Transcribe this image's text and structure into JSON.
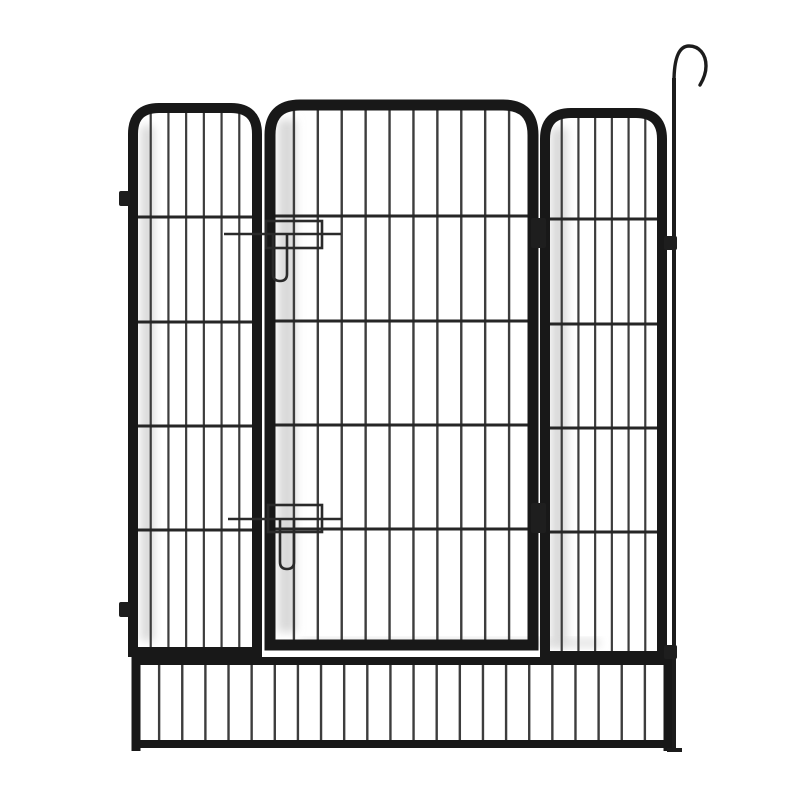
{
  "canvas": {
    "width": 800,
    "height": 800,
    "background": "#ffffff"
  },
  "colors": {
    "tube": "#181818",
    "wire": "#3d3d3d",
    "crossbar": "#262626",
    "hardware": "#1e1e1e",
    "latch_wire": "#2a2a2a",
    "shadow": "#d9d9d9",
    "stake": "#1c1c1c"
  },
  "panels": [
    {
      "id": "left-panel",
      "x1": 133,
      "x2": 257,
      "top": 108,
      "bottom": 652,
      "radius": 26,
      "tube_w": 10,
      "wires": 6,
      "wire_w": 2.2,
      "crossbars": [
        217,
        322,
        426,
        530
      ]
    },
    {
      "id": "gate-panel",
      "x1": 270,
      "x2": 533,
      "top": 105,
      "bottom": 645,
      "radius": 30,
      "tube_w": 11,
      "wires": 10,
      "wire_w": 2.4,
      "crossbars": [
        216,
        321,
        425,
        529
      ]
    },
    {
      "id": "right-panel",
      "x1": 545,
      "x2": 662,
      "top": 113,
      "bottom": 656,
      "radius": 26,
      "tube_w": 10,
      "wires": 6,
      "wire_w": 2.2,
      "crossbars": [
        219,
        324,
        428,
        532
      ]
    }
  ],
  "bottom_panel": {
    "id": "bottom-skirt-panel",
    "x1": 136,
    "x2": 668,
    "top_rail": 661,
    "bottom_rail": 744,
    "rail_w": 8,
    "bars": 22,
    "bar_w": 2.4,
    "bar_top": 663,
    "bar_bottom": 742,
    "end_tube_w": 9,
    "foot_bottom": 751
  },
  "gate_hardware": {
    "hinges": [
      {
        "x": 531,
        "y": 218,
        "w": 15,
        "h": 30
      },
      {
        "x": 531,
        "y": 503,
        "w": 15,
        "h": 30
      }
    ],
    "latch_upper": {
      "frame_rect": {
        "x": 266,
        "y": 221,
        "w": 56,
        "h": 27
      },
      "rod": {
        "x1": 224,
        "x2": 341,
        "y": 234
      },
      "pin": {
        "x1": 273,
        "x2": 287,
        "top": 234,
        "bottom": 281
      }
    },
    "latch_lower": {
      "frame_rect": {
        "x": 268,
        "y": 505,
        "w": 54,
        "h": 27
      },
      "rod": {
        "x1": 228,
        "x2": 342,
        "y": 519
      },
      "pin": {
        "x1": 280,
        "x2": 294,
        "top": 519,
        "bottom": 569
      }
    },
    "latch_w": 2.6
  },
  "side_tabs": [
    {
      "x": 119,
      "y": 191,
      "w": 11,
      "h": 15
    },
    {
      "x": 119,
      "y": 602,
      "w": 11,
      "h": 15
    }
  ],
  "ground_stake": {
    "id": "shepherd-hook-stake",
    "rod_x": 674,
    "rod_top": 78,
    "rod_bottom": 752,
    "rod_w": 4,
    "hook_path": "M 674,82 C 674,56 680,46 689,46 C 699,46 706,54 706,66 C 706,74 703,80 700,85",
    "hook_w": 3.4,
    "brackets": [
      {
        "x": 664,
        "y": 236,
        "w": 13,
        "h": 14
      },
      {
        "x": 664,
        "y": 645,
        "w": 13,
        "h": 14
      }
    ],
    "foot": {
      "x1": 667,
      "x2": 682,
      "y": 750,
      "w": 4
    }
  },
  "shadows": [
    {
      "x": 141,
      "y": 126,
      "w": 13,
      "h": 515
    },
    {
      "x": 278,
      "y": 120,
      "w": 18,
      "h": 512
    },
    {
      "x": 551,
      "y": 128,
      "w": 16,
      "h": 518
    },
    {
      "x": 300,
      "y": 640,
      "w": 300,
      "h": 6
    }
  ]
}
